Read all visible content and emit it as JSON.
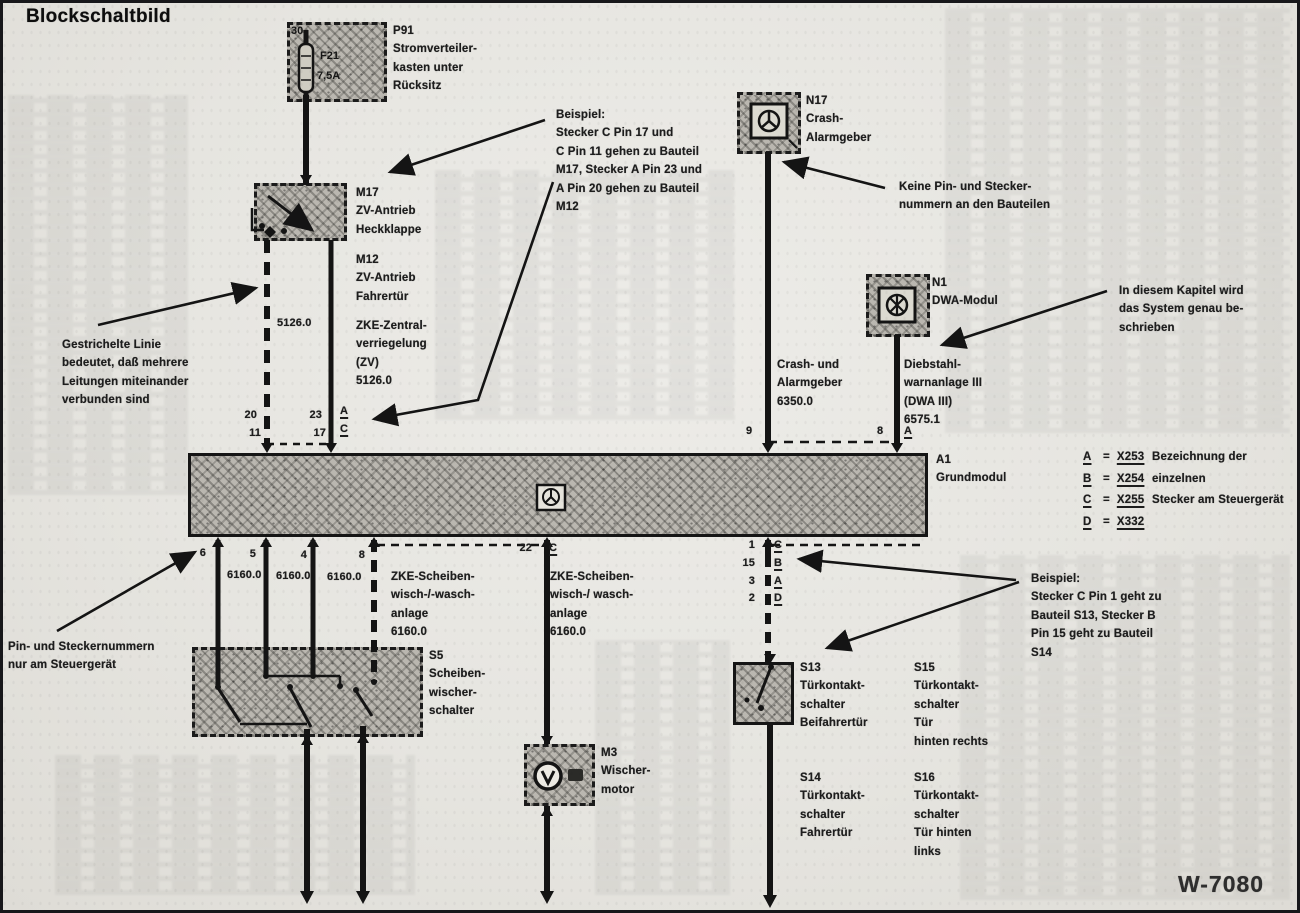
{
  "title": "Blockschaltbild",
  "doc_number": "W-7080",
  "components": {
    "p91": {
      "id": "P91",
      "desc": "Stromverteiler-\nkasten unter\nRücksitz",
      "pin": "30",
      "fuse": "F21",
      "fuse_rating": "7,5A"
    },
    "m17": {
      "id": "M17",
      "desc": "ZV-Antrieb\nHeckklappe"
    },
    "m12": {
      "id": "M12",
      "desc": "ZV-Antrieb\nFahrertür"
    },
    "n17": {
      "id": "N17",
      "desc": "Crash-\nAlarmgeber"
    },
    "n1": {
      "id": "N1",
      "desc": "DWA-Modul"
    },
    "a1": {
      "id": "A1",
      "desc": "Grundmodul"
    },
    "s5": {
      "id": "S5",
      "desc": "Scheiben-\nwischer-\nschalter"
    },
    "m3": {
      "id": "M3",
      "desc": "Wischer-\nmotor"
    },
    "s13": {
      "id": "S13",
      "desc": "Türkontakt-\nschalter\nBeifahrertür"
    },
    "s15": {
      "id": "S15",
      "desc": "Türkontakt-\nschalter\nTür\nhinten rechts"
    },
    "s14": {
      "id": "S14",
      "desc": "Türkontakt-\nschalter\nFahrertür"
    },
    "s16": {
      "id": "S16",
      "desc": "Türkontakt-\nschalter\nTür hinten\nlinks"
    }
  },
  "circuits": {
    "zv": {
      "wire": "5126.0",
      "label": "ZKE-Zentral-\nverriegelung\n(ZV)\n5126.0"
    },
    "crash": {
      "label": "Crash- und\nAlarmgeber\n6350.0"
    },
    "dwa": {
      "label": "Diebstahl-\nwarnanlage III\n(DWA III)\n6575.1"
    },
    "wisch_left": {
      "label": "ZKE-Scheiben-\nwisch-/-wasch-\nanlage\n6160.0",
      "wires": [
        "6160.0",
        "6160.0",
        "6160.0"
      ]
    },
    "wisch_mid": {
      "label": "ZKE-Scheiben-\nwisch-/ wasch-\nanlage\n6160.0"
    }
  },
  "pins": {
    "a1_top_left": {
      "p20": "20",
      "p11": "11",
      "p23": "23",
      "p17": "17",
      "a": "A",
      "c": "C"
    },
    "a1_top_right": {
      "p9": "9",
      "p8": "8",
      "a": "A"
    },
    "a1_bottom_left": [
      "6",
      "5",
      "4",
      "8"
    ],
    "a1_bottom_mid": {
      "p22": "22",
      "c": "C"
    },
    "a1_bottom_right": {
      "nums": [
        "1",
        "15",
        "3",
        "2"
      ],
      "letters": [
        "C",
        "B",
        "A",
        "D"
      ]
    }
  },
  "legend": {
    "eq": "=",
    "rows": [
      {
        "k": "A",
        "v": "X253"
      },
      {
        "k": "B",
        "v": "X254"
      },
      {
        "k": "C",
        "v": "X255"
      },
      {
        "k": "D",
        "v": "X332"
      }
    ],
    "note": "Bezeichnung der einzelnen\nStecker am Steuergerät"
  },
  "notes": {
    "beispiel_top": "Beispiel:\nStecker C Pin 17 und\nC Pin 11 gehen zu Bauteil\nM17, Stecker A Pin 23 und\nA Pin 20 gehen zu Bauteil\nM12",
    "beispiel_right": "Beispiel:\nStecker C Pin 1 geht zu\nBauteil S13, Stecker B\nPin 15 geht zu Bauteil\nS14",
    "dashed_line": "Gestrichelte Linie\nbedeutet, daß mehrere\nLeitungen miteinander\nverbunden sind",
    "no_pins": "Keine Pin- und Stecker-\nnummern an den Bauteilen",
    "chapter": "In diesem Kapitel wird\ndas System genau be-\nschrieben",
    "pins_only": "Pin- und Steckernummern\nnur am Steuergerät"
  }
}
